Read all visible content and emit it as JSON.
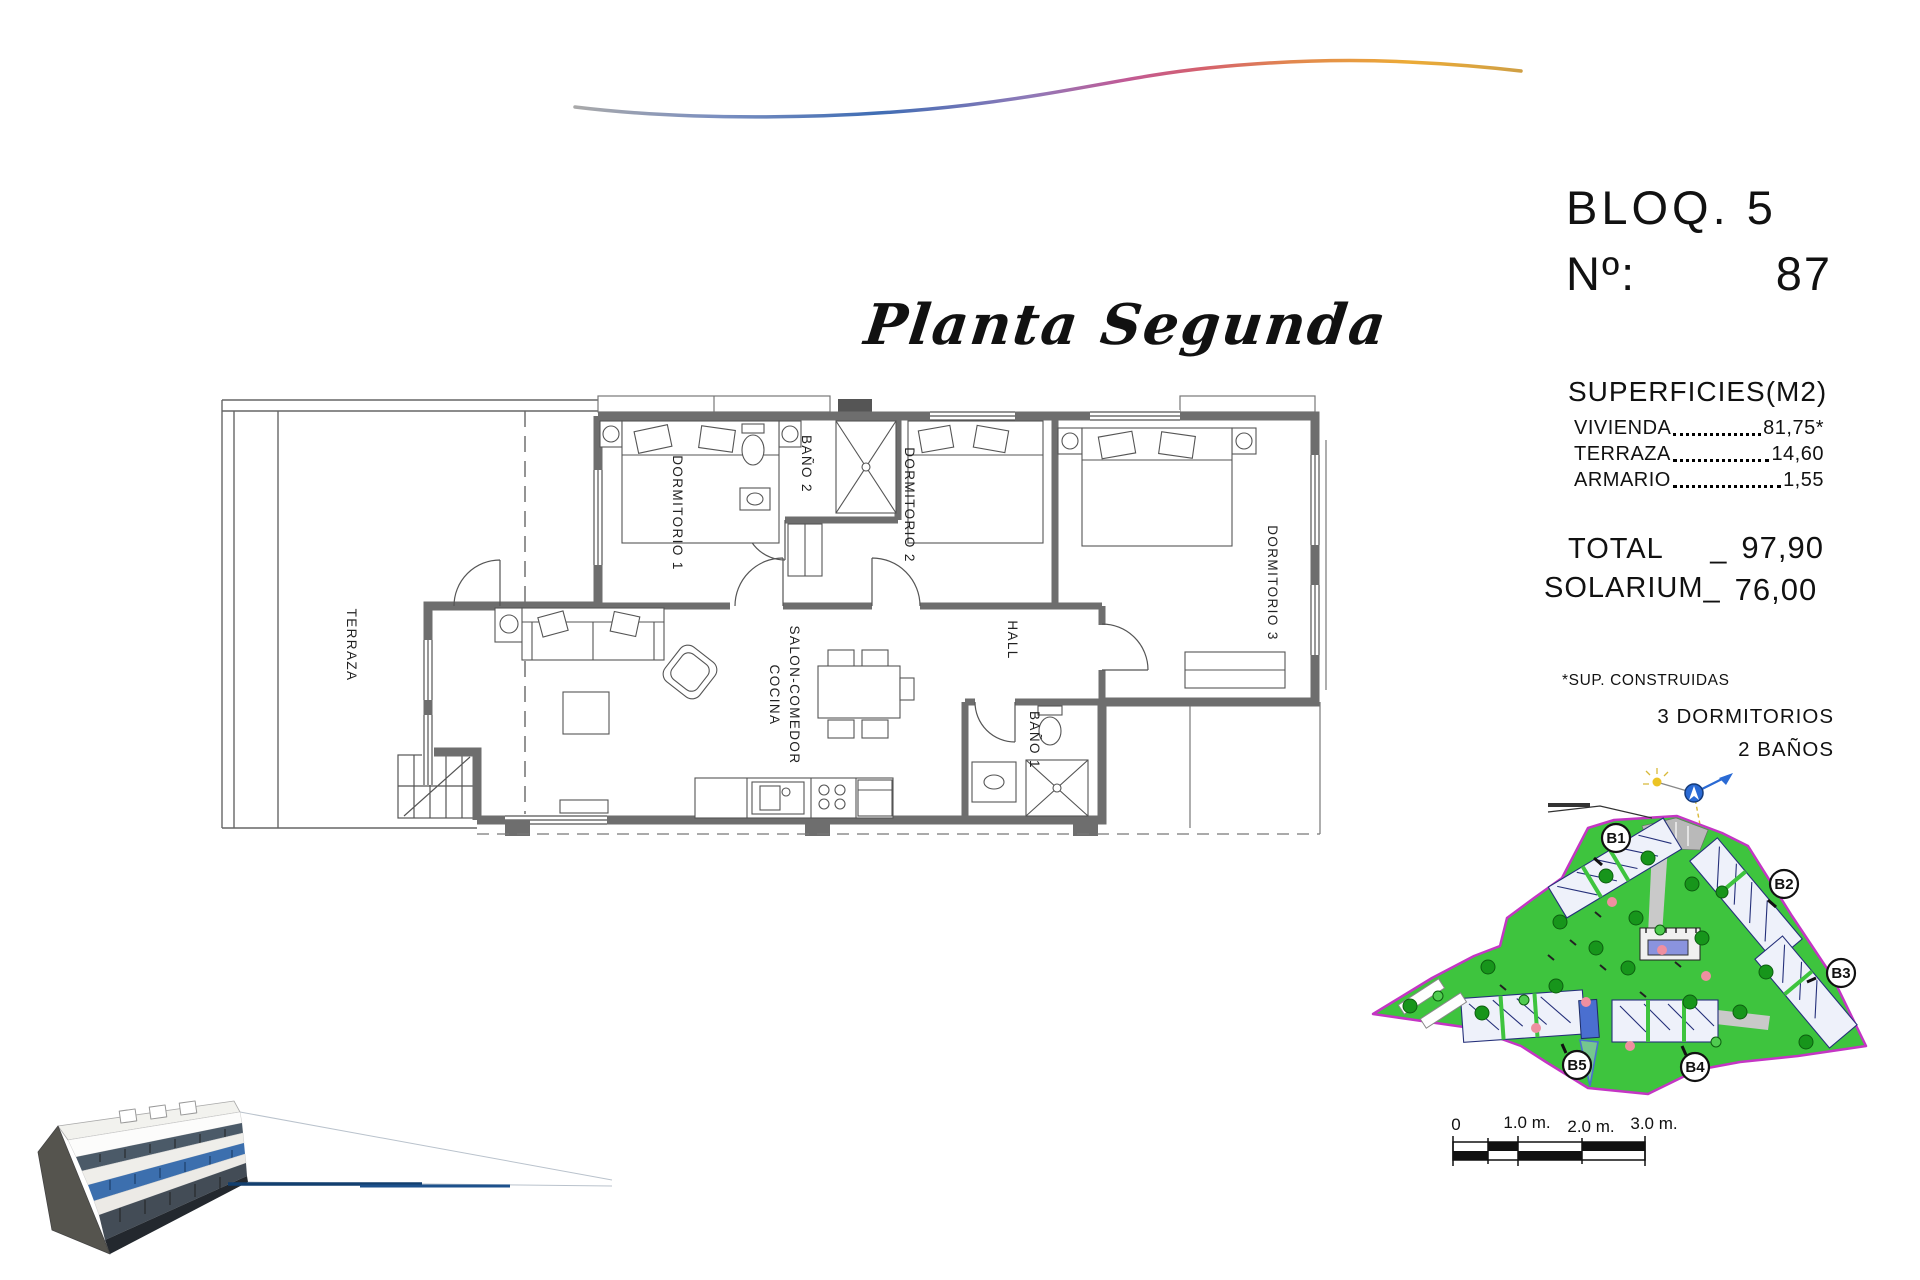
{
  "title": "Planta Segunda",
  "header": {
    "block": "BLOQ. 5",
    "unit_label": "Nº:",
    "unit_number": "87"
  },
  "areas": {
    "heading": "SUPERFICIES(M2)",
    "rows": [
      {
        "label": "VIVIENDA",
        "value": "81,75*"
      },
      {
        "label": "TERRAZA",
        "value": "14,60"
      },
      {
        "label": "ARMARIO",
        "value": "1,55"
      }
    ],
    "total_label": "TOTAL",
    "total_sep": "_",
    "total_value": "97,90",
    "solarium_label": "SOLARIUM_",
    "solarium_value": "76,00",
    "footnote": "*SUP. CONSTRUIDAS",
    "program_line1": "3 DORMITORIOS",
    "program_line2": "2 BAÑOS"
  },
  "floorplan": {
    "terraza": "TERRAZA",
    "dormitorio1": "DORMITORIO 1",
    "bano2": "BAÑO 2",
    "dormitorio2": "DORMITORIO 2",
    "dormitorio3": "DORMITORIO 3",
    "hall": "HALL",
    "salon_line1": "SALON-COMEDOR",
    "salon_line2": "COCINA",
    "bano1": "BAÑO 1"
  },
  "siteplan": {
    "b1": "B1",
    "b2": "B2",
    "b3": "B3",
    "b4": "B4",
    "b5": "B5"
  },
  "scalebar": {
    "t0": "0",
    "t1": "1.0 m.",
    "t2": "2.0 m.",
    "t3": "3.0 m."
  },
  "colors": {
    "lawn_green": "#3ec43e",
    "plot_border": "#c435c4",
    "building_navy": "#25307a",
    "highlight_unit_blue": "#4a6fd0",
    "footer_line_blue": "#1d518c",
    "wall_grey": "#6e6e6e"
  }
}
